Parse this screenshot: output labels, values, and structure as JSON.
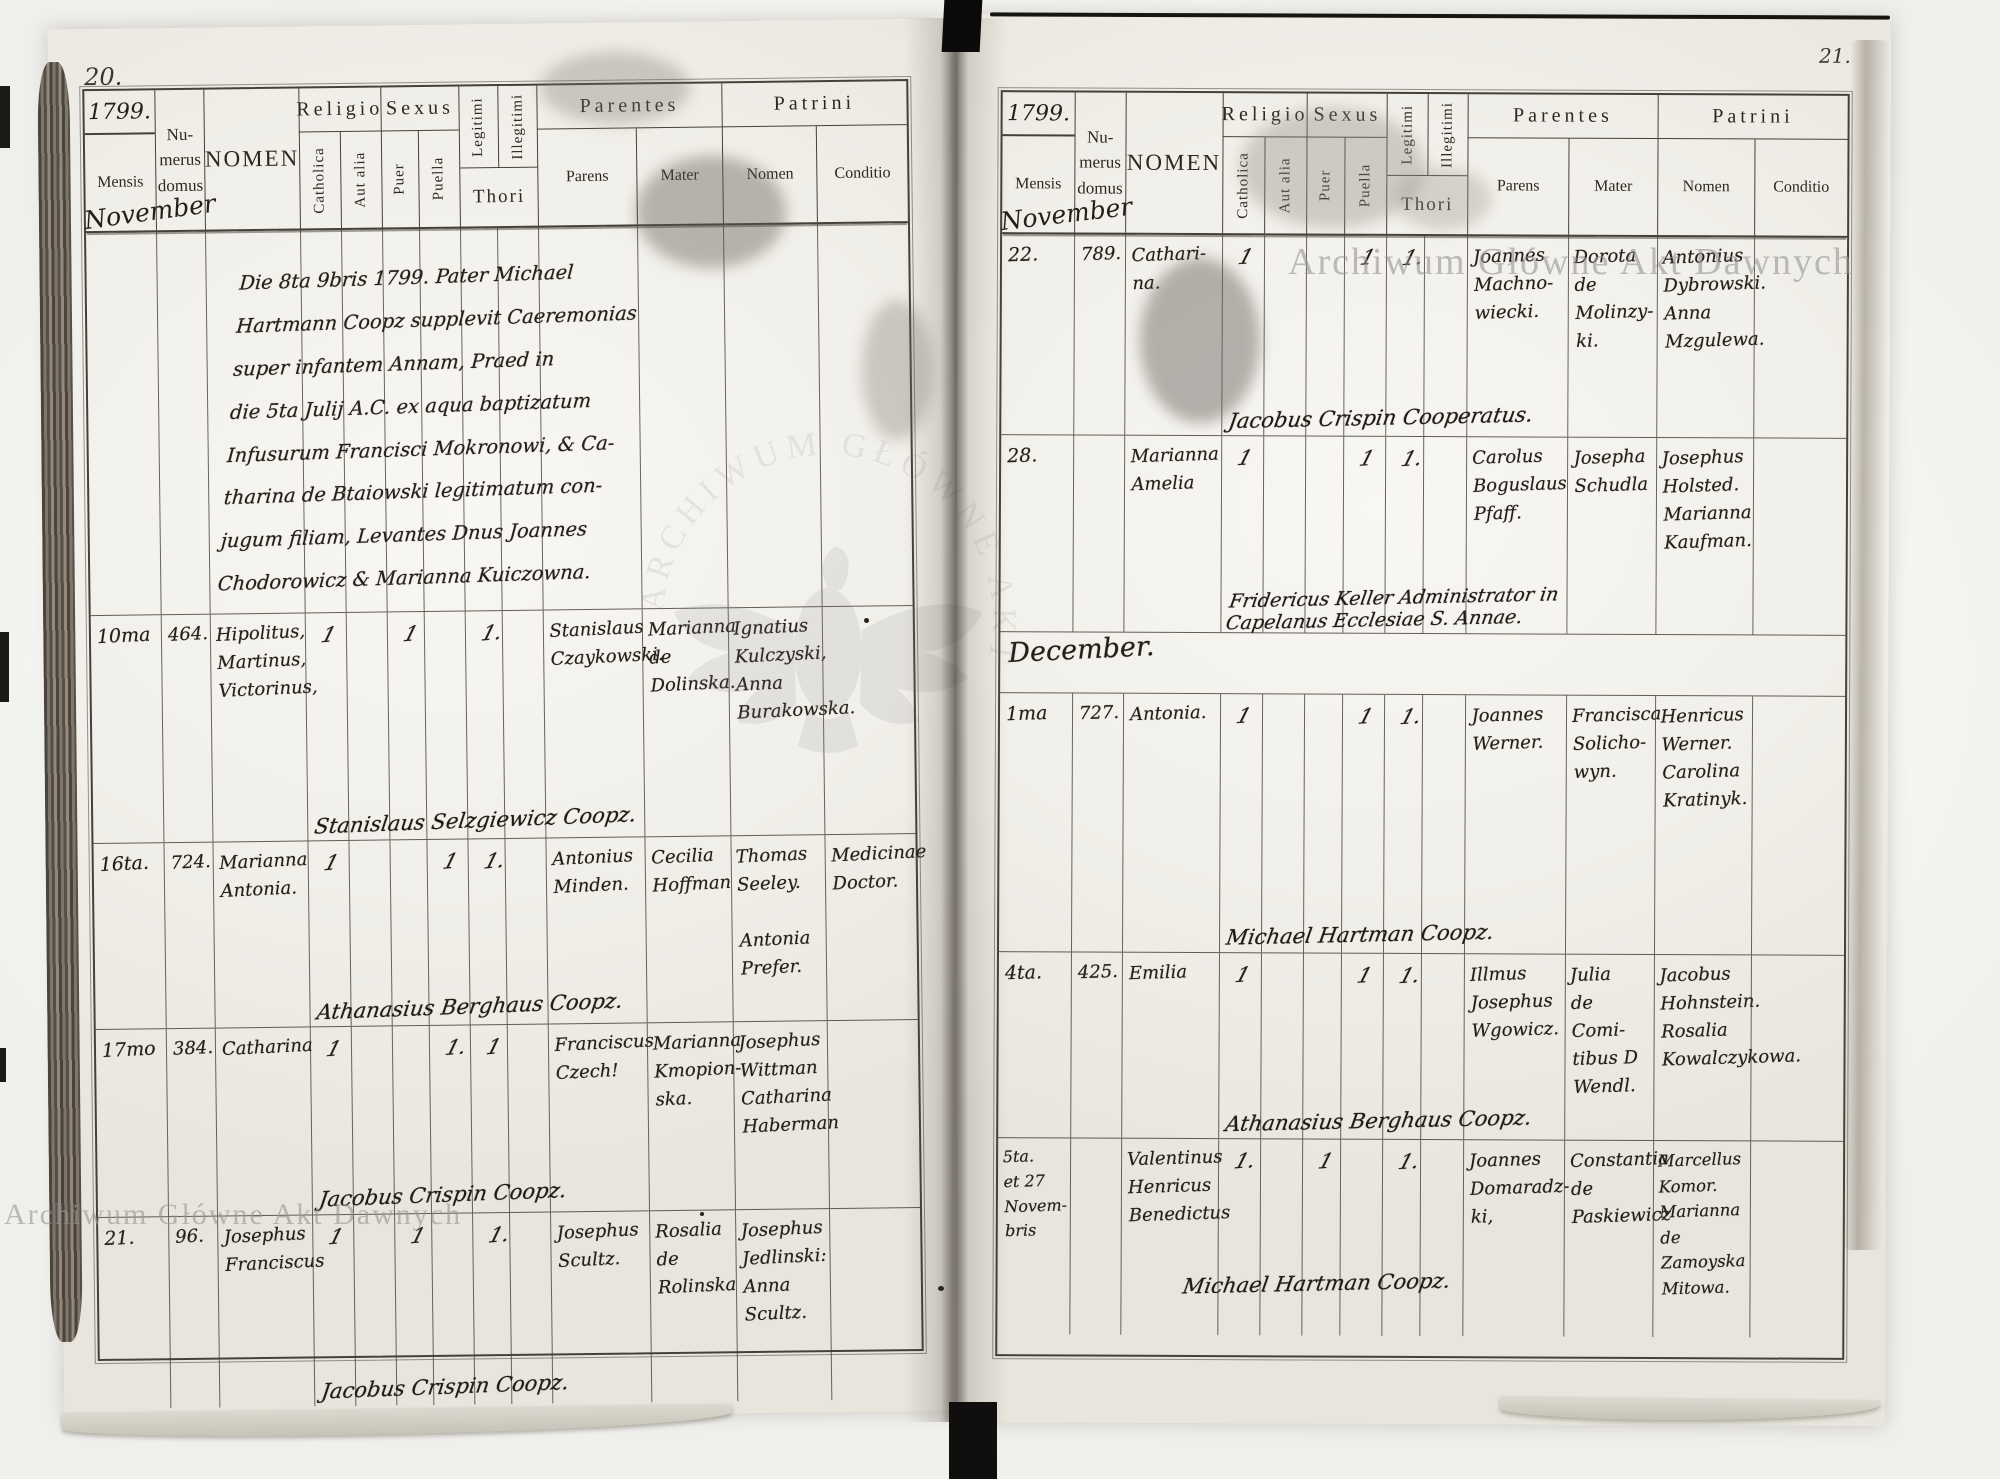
{
  "document_type": "parish baptism register spread, 1799",
  "watermarks": {
    "top_right": "Archiwum Główne Akt Dawnych",
    "bottom_left": "Archiwum Główne Akt Dawnych",
    "center_emblem_text": "ARCHIWUM GŁÓWNE AKT DAWNYCH"
  },
  "column_headers": {
    "mensis": "Mensis",
    "numerus_line1": "Nu-",
    "numerus_line2": "merus",
    "numerus_line3": "domus",
    "nomen": "NOMEN",
    "religio": "Religio",
    "catholica": "Catholica",
    "aut_alia": "Aut alia",
    "sexus": "Sexus",
    "puer": "Puer",
    "puella": "Puella",
    "legitimi": "Legitimi",
    "illegitimi": "Illegitimi",
    "thori": "Thori",
    "parentes": "Parentes",
    "parens": "Parens",
    "mater": "Mater",
    "patrini": "Patrini",
    "patrini_nomen": "Nomen",
    "conditio": "Conditio"
  },
  "left": {
    "page_number": "20.",
    "year": "1799.",
    "month_written": "November",
    "note": "Die 8ta 9bris 1799. Pater Michael\nHartmann Coopz supplevit Caeremonias\nsuper infantem Annam, Praed in\ndie 5ta Julij A.C. ex aqua baptizatum\nInfusurum Francisci Mokronowi, & Ca-\ntharina de Btaiowski legitimatum con-\njugum filiam, Levantes Dnus Joannes\nChodorowicz & Marianna Kuiczowna.",
    "entries": [
      {
        "date": "10ma",
        "num": "464.",
        "nomen": "Hipolitus,\nMartinus,\nVictorinus,",
        "catholica": "1",
        "aut_alia": "",
        "puer": "1",
        "puella": "",
        "legitimi": "1.",
        "illegitimi": "",
        "parens": "Stanislaus\nCzaykowski.",
        "mater": "Marianna\nde\nDolinska.",
        "patrini": "Ignatius\nKulczyski,\nAnna\nBurakowska.",
        "conditio": "",
        "officiant": "Stanislaus Selzgiewicz Coopz."
      },
      {
        "date": "16ta.",
        "num": "724.",
        "nomen": "Marianna\nAntonia.",
        "catholica": "1",
        "aut_alia": "",
        "puer": "",
        "puella": "1",
        "legitimi": "1.",
        "illegitimi": "",
        "parens": "Antonius\nMinden.",
        "mater": "Cecilia\nHoffman",
        "patrini": "Thomas\nSeeley.\n\nAntonia\nPrefer.",
        "conditio": "Medicinae\nDoctor.",
        "officiant": "Athanasius Berghaus Coopz."
      },
      {
        "date": "17mo",
        "num": "384.",
        "nomen": "Catharina",
        "catholica": "1",
        "aut_alia": "",
        "puer": "",
        "puella": "1.",
        "legitimi": "1",
        "illegitimi": "",
        "parens": "Franciscus\nCzech!",
        "mater": "Marianna\nKmopion-\nska.",
        "patrini": "Josephus\nWittman\nCatharina\nHaberman",
        "conditio": "",
        "officiant": "Jacobus Crispin Coopz."
      },
      {
        "date": "21.",
        "num": "96.",
        "nomen": "Josephus\nFranciscus",
        "catholica": "1",
        "aut_alia": "",
        "puer": "1",
        "puella": "",
        "legitimi": "1.",
        "illegitimi": "",
        "parens": "Josephus\nScultz.",
        "mater": "Rosalia\nde\nRolinska",
        "patrini": "Josephus\nJedlinski:\nAnna\nScultz.",
        "conditio": "",
        "officiant": "Jacobus Crispin Coopz."
      }
    ]
  },
  "right": {
    "page_number": "21.",
    "year": "1799.",
    "month_written": "November",
    "section_label": "December.",
    "entries": [
      {
        "date": "22.",
        "num": "789.",
        "nomen": "Cathari-\nna.",
        "catholica": "1",
        "aut_alia": "",
        "puer": "",
        "puella": "1",
        "legitimi": "1.",
        "illegitimi": "",
        "parens": "Joannes\nMachno-\nwiecki.",
        "mater": "Dorota\nde\nMolinzy-\nki.",
        "patrini": "Antonius\nDybrowski.\nAnna\nMzgulewa.",
        "conditio": "",
        "officiant": "Jacobus Crispin Cooperatus."
      },
      {
        "date": "28.",
        "num": "",
        "nomen": "Marianna\nAmelia",
        "catholica": "1",
        "aut_alia": "",
        "puer": "",
        "puella": "1",
        "legitimi": "1.",
        "illegitimi": "",
        "parens": "Carolus\nBoguslaus\nPfaff.",
        "mater": "Josepha\nSchudla",
        "patrini": "Josephus\nHolsted.\nMarianna\nKaufman.",
        "conditio": "",
        "officiant": "Fridericus Keller Administrator in\nCapelanus Ecclesiae S. Annae."
      },
      {
        "date": "1ma",
        "num": "727.",
        "nomen": "Antonia.",
        "catholica": "1",
        "aut_alia": "",
        "puer": "",
        "puella": "1",
        "legitimi": "1.",
        "illegitimi": "",
        "parens": "Joannes\nWerner.",
        "mater": "Francisca\nSolicho-\nwyn.",
        "patrini": "Henricus\nWerner.\nCarolina\nKratinyk.",
        "conditio": "",
        "officiant": "Michael Hartman Coopz."
      },
      {
        "date": "4ta.",
        "num": "425.",
        "nomen": "Emilia",
        "catholica": "1",
        "aut_alia": "",
        "puer": "",
        "puella": "1",
        "legitimi": "1.",
        "illegitimi": "",
        "parens": "Illmus\nJosephus\nWgowicz.",
        "mater": "Julia\nde Comi-\ntibus D\nWendl.",
        "patrini": "Jacobus\nHohnstein.\nRosalia\nKowalczykowa.",
        "conditio": "",
        "officiant": "Athanasius Berghaus Coopz."
      },
      {
        "date": "5ta.\net 27\nNovem-\nbris",
        "num": "",
        "nomen": "Valentinus\nHenricus\nBenedictus",
        "catholica": "1.",
        "aut_alia": "",
        "puer": "1",
        "puella": "",
        "legitimi": "1.",
        "illegitimi": "",
        "parens": "Joannes\nDomaradz-\nki,",
        "mater": "Constantia\nde\nPaskiewicz",
        "patrini": "Marcellus\nKomor.\nMarianna\nde Zamoyska\nMitowa.",
        "conditio": "",
        "officiant": "Michael Hartman Coopz."
      }
    ]
  }
}
